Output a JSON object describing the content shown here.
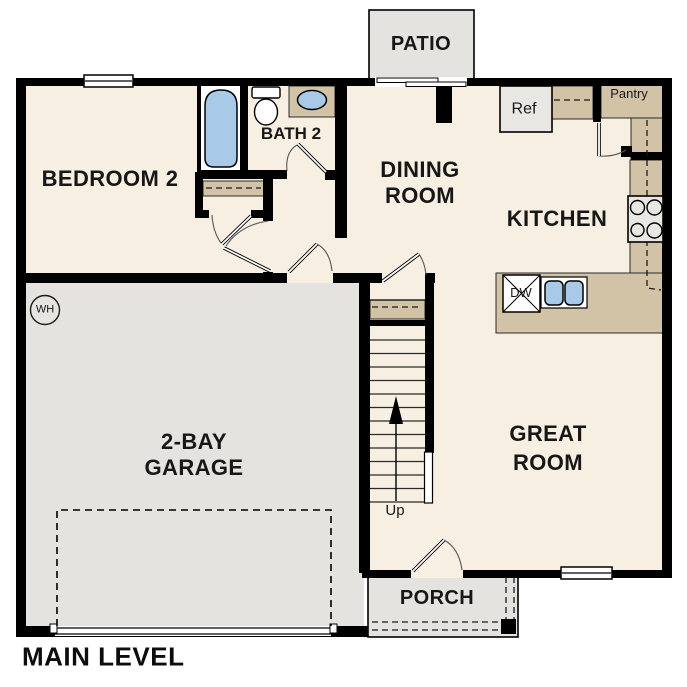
{
  "title": "MAIN LEVEL",
  "rooms": {
    "bedroom2": "BEDROOM 2",
    "bath2": "BATH 2",
    "dining_line1": "DINING",
    "dining_line2": "ROOM",
    "kitchen": "KITCHEN",
    "great_line1": "GREAT",
    "great_line2": "ROOM",
    "garage_line1": "2-BAY",
    "garage_line2": "GARAGE",
    "patio": "PATIO",
    "porch": "PORCH"
  },
  "fixtures": {
    "refrigerator": "Ref",
    "pantry": "Pantry",
    "dishwasher": "DW",
    "stairs_direction": "Up",
    "water_heater": "WH"
  },
  "colors": {
    "floor": "#f7efe2",
    "garage_floor": "#e4e3df",
    "counter": "#d2c3a6",
    "fixture_blue": "#a9c9e9",
    "appliance": "#e8e7e4",
    "wall": "#000000",
    "background": "#ffffff"
  }
}
